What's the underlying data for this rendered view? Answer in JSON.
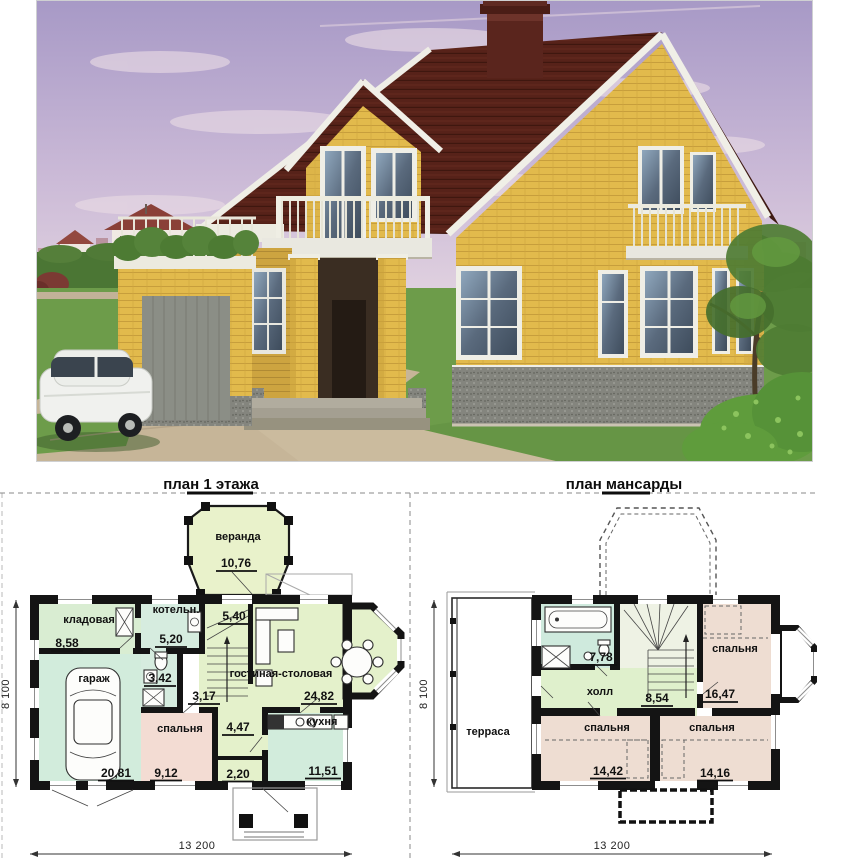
{
  "plans": {
    "floor1": {
      "title": "план 1 этажа",
      "rooms": {
        "veranda": {
          "name": "веранда",
          "area": "10,76"
        },
        "storage": {
          "name": "кладовая",
          "area": "8,58"
        },
        "boiler": {
          "name": "котельн.",
          "area": "5,20"
        },
        "stair_hall": {
          "area": "5,40"
        },
        "living_dining": {
          "name": "гостиная-столовая",
          "area": "24,82"
        },
        "garage": {
          "name": "гараж",
          "area": "20,81"
        },
        "bathroom": {
          "area": "3,42"
        },
        "corridor": {
          "area": "3,17"
        },
        "bedroom": {
          "name": "спальня",
          "area": "9,12"
        },
        "hall": {
          "area": "4,47"
        },
        "entry": {
          "area": "2,20"
        },
        "kitchen": {
          "name": "кухня",
          "area": "11,51"
        }
      },
      "dims": {
        "height": "8 100",
        "width": "13 200"
      }
    },
    "attic": {
      "title": "план мансарды",
      "rooms": {
        "bathroom": {
          "area": "7,78"
        },
        "hall": {
          "name": "холл",
          "area": "8,54"
        },
        "bedroom1": {
          "name": "спальня",
          "area": "16,47"
        },
        "bedroom2": {
          "name": "спальня",
          "area": "14,42"
        },
        "bedroom3": {
          "name": "спальня",
          "area": "14,16"
        },
        "terrace": {
          "name": "терраса"
        }
      },
      "dims": {
        "height": "8 100",
        "width": "13 200"
      }
    }
  },
  "colors": {
    "roof": "#57251e",
    "brick_wall": "#e2ba4c",
    "granite_base": "#85867f",
    "sky": "#ab9cc8",
    "lawn": "#6d9c4a",
    "room_green": "#d9edd2",
    "room_mint": "#d3ebdc",
    "room_yellow_green": "#e4f1cb",
    "room_pink": "#f3dcd3",
    "attic_pink": "#eeddd2",
    "attic_mint": "#cfeadd"
  }
}
